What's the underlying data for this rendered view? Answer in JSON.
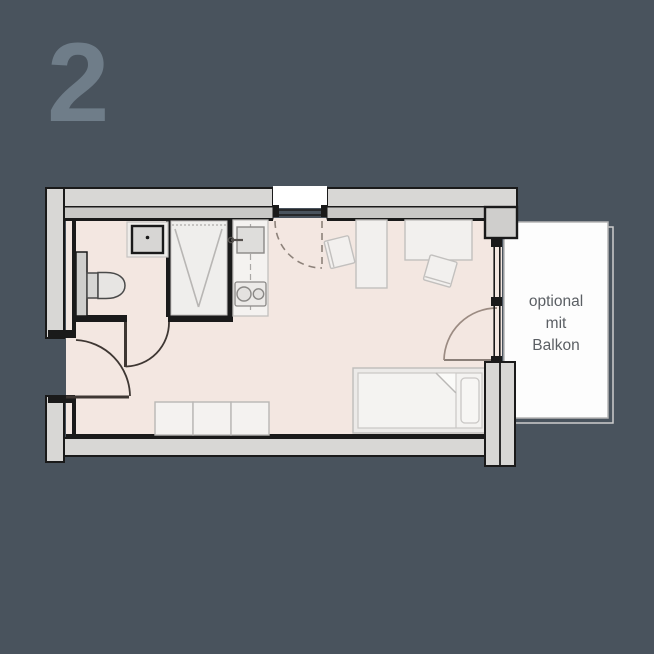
{
  "plan": {
    "number": "2",
    "type": "floor-plan",
    "features": [
      "bathroom",
      "shower",
      "washbasin",
      "toilet",
      "kitchenette",
      "kitchen-sink",
      "cooktop",
      "wardrobe",
      "desk",
      "desk-chair",
      "single-bed",
      "entrance-door",
      "bathroom-door",
      "window-door",
      "balcony-door",
      "balcony"
    ]
  },
  "balcony": {
    "line1": "optional",
    "line2": "mit",
    "line3": "Balkon"
  },
  "colors": {
    "background": "#49535d",
    "numeral": "#6f7d89",
    "floor": "#f3e7e1",
    "wall_fill": "#d8d7d5",
    "wall_inner": "#c9c8c6",
    "wall_line": "#1a1a1a",
    "furniture_fill": "#f2f0ee",
    "furniture_line": "#c2c0be",
    "fixture_fill": "#d7d6d4",
    "door_arc": "#3e3733",
    "dash_arc": "#8d827a",
    "balcony_door_arc": "#9b8b82",
    "balcony_text": "#5b5f64"
  }
}
